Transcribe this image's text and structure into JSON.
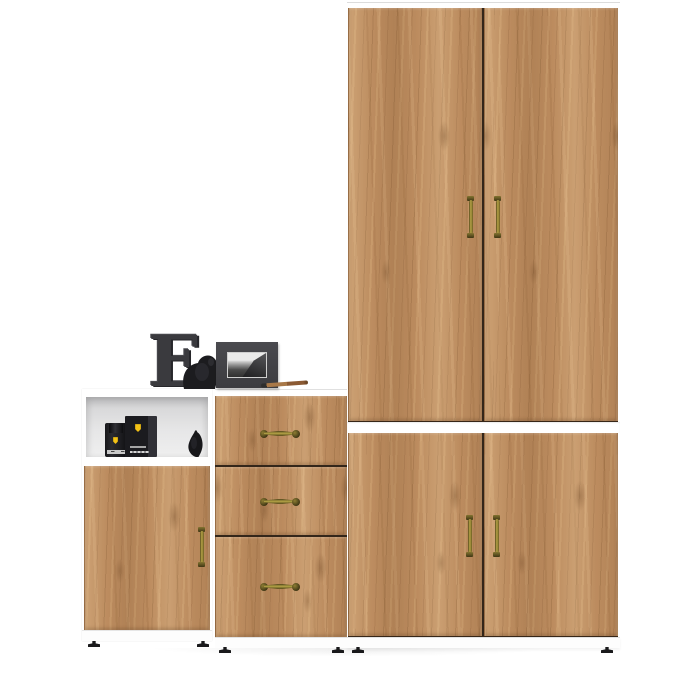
{
  "scene": {
    "description": "Product photo of a hallway furniture set: white carcasses with golden oak fronts and antique brass handles, decorated with black figurines",
    "background_color": "#ffffff",
    "colors": {
      "wood_base": "#bc8c5f",
      "wood_light": "#d9ae7d",
      "wood_dark": "#8a5f38",
      "carcass_white": "#ffffff",
      "brass_handle": "#a59136",
      "brass_handle_dark": "#4e431a",
      "decor_charcoal": "#3a3a3e",
      "ferrari_yellow": "#f3c216",
      "niche_gray": "#e0e0e1",
      "feet_black": "#1a1a1c"
    },
    "units": [
      {
        "id": "left-cabinet",
        "label": "White low cabinet with open shelf niche and oak door"
      },
      {
        "id": "drawer-chest",
        "label": "Oak chest with three drawers"
      },
      {
        "id": "tall-wardrobe",
        "label": "Tall oak two-door wardrobe"
      },
      {
        "id": "lower-cabinet",
        "label": "Oak two-door lower cabinet"
      }
    ],
    "decor": [
      {
        "id": "letter-e",
        "label": "Decorative charcoal letter E",
        "glyph": "E"
      },
      {
        "id": "elephant-figurine",
        "label": "Black elephant figurine with raised trunk"
      },
      {
        "id": "photo-frame",
        "label": "Dark gray frame with grayscale landscape photo"
      },
      {
        "id": "pen",
        "label": "Wooden pen lying on the top"
      },
      {
        "id": "perfume-bottle",
        "label": "Black perfume bottle with yellow shield emblem"
      },
      {
        "id": "perfume-box",
        "label": "Black perfume box with yellow shield emblem"
      },
      {
        "id": "bird-figurine",
        "label": "Black bird figurine"
      }
    ],
    "counts": {
      "doors": 5,
      "drawers": 3,
      "handles": 8,
      "visible_feet": 6
    }
  }
}
